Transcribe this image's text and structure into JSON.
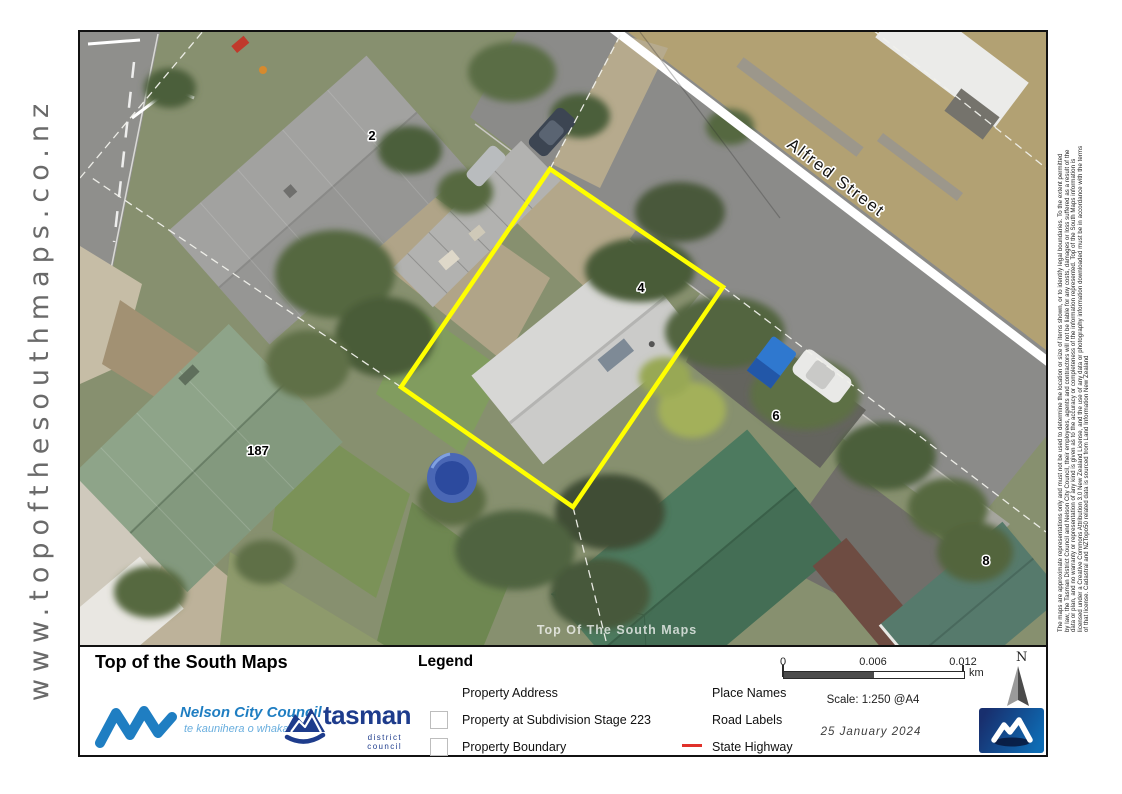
{
  "page": {
    "url": "www.topofthesouthmaps.co.nz"
  },
  "map": {
    "street": "Alfred Street",
    "watermark": "Top Of The South Maps",
    "parcels": [
      "2",
      "4",
      "6",
      "8",
      "187"
    ],
    "colors": {
      "property_boundary": "#ffff00",
      "road_line": "#ffffff"
    }
  },
  "footer": {
    "title": "Top of the South Maps",
    "legend": {
      "title": "Legend",
      "col1": [
        {
          "label": "Property Address",
          "swatch": "none"
        },
        {
          "label": "Property at Subdivision Stage 223",
          "swatch": "square"
        },
        {
          "label": "Property Boundary",
          "swatch": "square"
        }
      ],
      "col2": [
        {
          "label": "Place Names",
          "swatch": "none"
        },
        {
          "label": "Road Labels",
          "swatch": "none"
        },
        {
          "label": "State Highway",
          "swatch": "red-line"
        }
      ],
      "colors": {
        "state_highway": "#e0312a"
      }
    },
    "scale": {
      "ticks": [
        "0",
        "0.006",
        "0.012"
      ],
      "unit": "km",
      "label": "Scale: 1:250 @A4"
    },
    "date": "25 January 2024",
    "north": "N",
    "logos": {
      "nelson": {
        "name": "Nelson City Council",
        "tagline": "te kaunihera o whakatū",
        "color": "#1f7ec2"
      },
      "tasman": {
        "name": "tasman",
        "sub": "district council",
        "color": "#1e3c8c"
      }
    }
  },
  "disclaimer_lines": [
    "The maps are approximate representations only and must not be used to determine the location or size of items shown, or to identify legal boundaries. To the extent permitted",
    "by law, the Tasman District Council and Nelson City Council, their employees, agents and contractors will not be liable for any costs, damages or loss suffered as a result of the",
    "data or plan, and no warranty or representation of any kind is given as to the accuracy or completeness of the information represented. Top of the South Maps information is",
    "licensed under a Creative Commons Attribution 3.0 New Zealand License, and the use of any data or photography information downloaded must be in accordance with the terms",
    "of that license. Cadastral and NZTopo50 related data is sourced from Land Information New Zealand"
  ]
}
